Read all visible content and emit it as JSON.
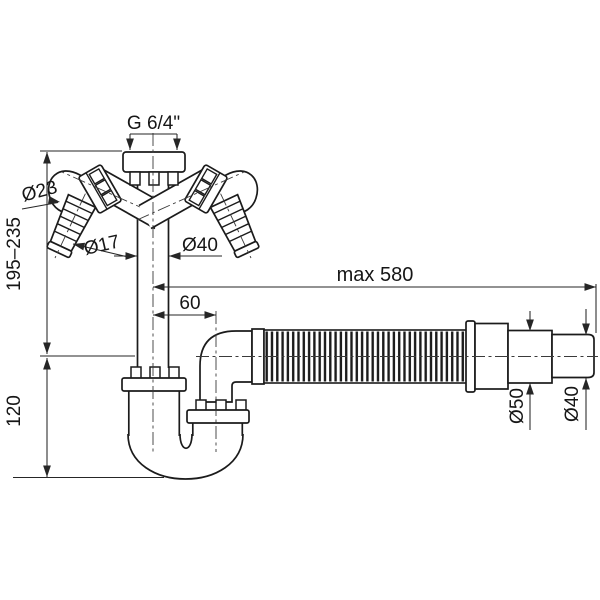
{
  "drawing": {
    "title": "siphon-technical-drawing",
    "colors": {
      "line": "#1b1b1b",
      "dim": "#262626",
      "background": "#ffffff"
    },
    "labels": {
      "thread_top": "G 6/4\"",
      "branch_nut_diameter": "Ø23",
      "branch_barb_diameter": "Ø17",
      "inlet_pipe_diameter": "Ø40",
      "install_height_range": "195–235",
      "trap_depth": "120",
      "axis_offset": "60",
      "hose_max_length": "max 580",
      "outlet_sleeve_diameter": "Ø50",
      "outlet_end_diameter": "Ø40"
    }
  }
}
